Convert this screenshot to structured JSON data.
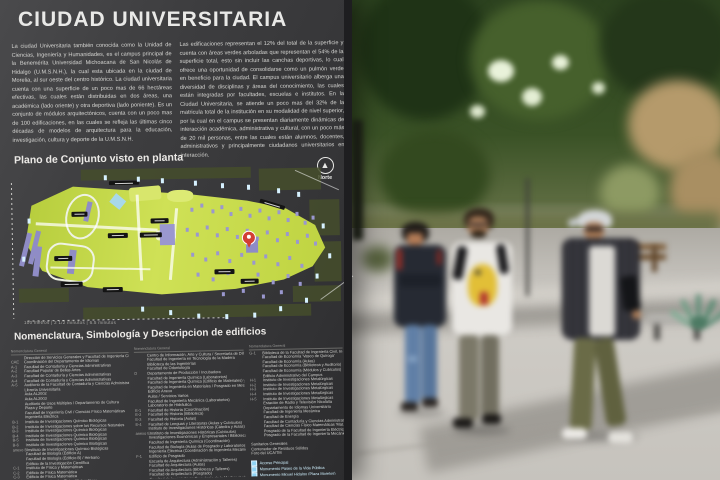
{
  "sign": {
    "title": "CIUDAD UNIVERSITARIA",
    "intro_left": "La ciudad Universitaria también conocida como la Unidad de Ciencias, Ingeniería y Humanidades, es el campus principal de la Benemérita Universidad Michoacana de San Nicolás de Hidalgo (U.M.S.N.H.), la cual esta ubicada en la ciudad de Morelia, al sur oeste del centro histórico. La ciudad universitaria cuenta con una superficie de un poco mas de 66 hectáreas efectivas, las cuales están distribuidas en dos áreas, una académica (lado oriente) y otra deportiva (lado poniente). Es un conjunto de módulos arquitectónicos, cuenta con un poco mas de 100 edificaciones, en las cuales se refleja las últimas cinco décadas de modelos de arquitectura para la educación, investigación, cultura y deporte de la U.M.S.N.H.",
    "intro_right": "Las edificaciones representan el 12% del total de la superficie y cuenta con áreas verdes arboladas que representan el 54% de la superficie total, esto sin incluir las canchas deportivas, lo cual ofrece una oportunidad de consolidarse como un pulmón verde en beneficio para la ciudad. El campus universitario alberga una diversidad de disciplinas y áreas del conocimiento, las cuales están integradas por facultades, escuelas e institutos. En la Ciudad Universitaria, se atiende un poco mas del 32% de la matricula total de la institución en su modalidad de nivel superior, por la cual en el campus se presentan diariamente dinámicas de interacción académica, administrativa y cultural, con un poco más de 20 mil personas, entre las cuales están alumnos, docentes, administrativos y principalmente ciudadanos universitarios en interacción.",
    "map": {
      "heading": "Plano de Conjunto visto en planta",
      "north_label": "Norte",
      "north_arrow_glyph": "▲",
      "scale_caption": "100 metros  |  2 1/2 minutos  |  6.5 minutos",
      "marker": "location-pin"
    },
    "legend": {
      "heading": "Nomenclatura, Simbología y Descripcion de edificios",
      "columns": [
        {
          "header": "Nomenclatura General",
          "entries": [
            {
              "code": "",
              "label": "Dirección de Servicios Generales y Facultad de Ingeniería Civil"
            },
            {
              "code": "CAE",
              "label": "Coordinación del Departamento de Idiomas"
            },
            {
              "code": "A-1",
              "label": "Facultad de Contaduría y Ciencias Administrativas"
            },
            {
              "code": "A-2",
              "label": "Facultad Popular de Bellas Artes"
            },
            {
              "code": "A-3",
              "label": "Facultad de Contaduría y Ciencias Administrativas"
            },
            {
              "code": "A-4",
              "label": "Facultad de Contaduría y Ciencias Administrativas"
            },
            {
              "code": "A-5",
              "label": "Auditorio de la Facultad de Contaduría y Ciencias Administrativas"
            },
            {
              "code": "",
              "label": "Librería Universitaria"
            },
            {
              "code": "",
              "label": "Aula AL2002"
            },
            {
              "code": "",
              "label": "Aula AL2003"
            },
            {
              "code": "",
              "label": "Auditorio de Usos Múltiples / Departamento de Cultura"
            },
            {
              "code": "",
              "label": "Plaza y Deporte"
            },
            {
              "code": "",
              "label": "Facultad de Ingeniería Civil / Ciencias Físico Matemáticas"
            },
            {
              "code": "",
              "label": "Ingeniería Eléctrica"
            },
            {
              "code": "B-1",
              "label": "Instituto de Investigaciones Químico Biológicas"
            },
            {
              "code": "B-2",
              "label": "Instituto de Investigaciones sobre los Recursos Naturales"
            },
            {
              "code": "B-3",
              "label": "Instituto de Investigaciones Químico Biológicas"
            },
            {
              "code": "B-4",
              "label": "Instituto de Investigaciones Químico Biológicas"
            },
            {
              "code": "B-5",
              "label": "Instituto de Investigaciones Químico Biológicas"
            },
            {
              "code": "B-6",
              "label": "Instituto de Investigaciones Químico Biológicas"
            },
            {
              "code": "anexo B",
              "label": "Instituto de Investigaciones Químico Biológicas"
            },
            {
              "code": "",
              "label": "Facultad de Biología (Edificio A)"
            },
            {
              "code": "",
              "label": "Facultad de Biología (Edificio B) / Herbario"
            },
            {
              "code": "",
              "label": "Edificio de la Investigación Científica"
            },
            {
              "code": "C-1",
              "label": "Instituto de Física y Matemáticas"
            },
            {
              "code": "C-2",
              "label": "Edificio de Física Matemática"
            },
            {
              "code": "C-3",
              "label": "Edificio de Física Matemática"
            },
            {
              "code": "",
              "label": "Facultad de Ciencias Físico Matemáticas"
            },
            {
              "code": "",
              "label": "Facultad de Filosofía"
            }
          ]
        },
        {
          "header": "Nomenclatura General",
          "entries": [
            {
              "code": "",
              "label": "Centro de Información, Arte y Cultura / Secretaría de Difusión Cultural"
            },
            {
              "code": "",
              "label": "Facultad de Ingeniería en Tecnología de la Madera"
            },
            {
              "code": "",
              "label": "Biblioteca de las Ingenierías"
            },
            {
              "code": "",
              "label": "Facultad de Odontología"
            },
            {
              "code": "D",
              "label": "Departamento de Producción / Incubadora"
            },
            {
              "code": "",
              "label": "Facultad de Ingeniería Química (Laboratorios)"
            },
            {
              "code": "",
              "label": "Facultad de Ingeniería Química (Edificio de Materiales) y Posgrado"
            },
            {
              "code": "",
              "label": "Facultad de Ingeniería en Materiales / Posgrado en Metalurgia"
            },
            {
              "code": "",
              "label": "Edificio Anexo"
            },
            {
              "code": "",
              "label": "Aulas / Servicios Varios"
            },
            {
              "code": "",
              "label": "Facultad de Ingeniería Mecánica (Laboratorios)"
            },
            {
              "code": "",
              "label": "Laboratorio de Hidráulica"
            },
            {
              "code": "E-1",
              "label": "Facultad de Historia (Coordinación)"
            },
            {
              "code": "E-2",
              "label": "Facultad de Historia (Biblioteca)"
            },
            {
              "code": "E-3",
              "label": "Facultad de Historia (Aulas)"
            },
            {
              "code": "E-4",
              "label": "Facultad de Lenguas y Literaturas (Aulas y Cubículos)"
            },
            {
              "code": "",
              "label": "Instituto de Investigaciones Históricas (Cátedra y Aulas)"
            },
            {
              "code": "anexo E",
              "label": "Instituto de Investigaciones Históricas (Cubículos)"
            },
            {
              "code": "",
              "label": "Investigaciones Económicas y Empresariales / Biblioteca y Hemeroteca"
            },
            {
              "code": "",
              "label": "Facultad de Ingeniería Química (Coordinación)"
            },
            {
              "code": "",
              "label": "Facultad de Biología (Aulas de Posgrado y Laboratorios)"
            },
            {
              "code": "",
              "label": "Ingeniería Eléctrica (Coordinación de Ingeniería Mecánica)"
            },
            {
              "code": "F-1",
              "label": "Edificio de Posgrado"
            },
            {
              "code": "",
              "label": "Escuela de Arquitectura (Administración y Talleres)"
            },
            {
              "code": "",
              "label": "Facultad de Arquitectura (Aulas)"
            },
            {
              "code": "",
              "label": "Facultad de Arquitectura (Biblioteca y Talleres)"
            },
            {
              "code": "",
              "label": "Facultad de Arquitectura (Posgrado)"
            },
            {
              "code": "",
              "label": "Facultad de Ingeniería en Tecnología de la Madera (Laboratorios)"
            },
            {
              "code": "",
              "label": "Facultad de Arquitectura (Talleres)"
            }
          ]
        },
        {
          "header": "Nomenclatura General",
          "entries": [
            {
              "code": "G-1",
              "label": "Biblioteca de la Facultad de Ingeniería Civil, Ingeniería Mecánica e Ingeniería en Tecnología de la Madera"
            },
            {
              "code": "",
              "label": "Facultad de Economía 'Vasco de Quiroga'"
            },
            {
              "code": "",
              "label": "Facultad de Economía (Aulas)"
            },
            {
              "code": "",
              "label": "Facultad de Economía (Biblioteca y Auditorio)"
            },
            {
              "code": "",
              "label": "Facultad de Economía (Módulos y Cubículos)"
            },
            {
              "code": "",
              "label": "Edificio Administrativo del Campus"
            },
            {
              "code": "H-1",
              "label": "Instituto de Investigaciones Metalúrgicas"
            },
            {
              "code": "H-2",
              "label": "Instituto de Investigaciones Metalúrgicas"
            },
            {
              "code": "H-3",
              "label": "Instituto de Investigaciones Metalúrgicas"
            },
            {
              "code": "H-4",
              "label": "Instituto de Investigaciones Metalúrgicas"
            },
            {
              "code": "H-5",
              "label": "Instituto de Investigaciones Metalúrgicas"
            },
            {
              "code": "",
              "label": "Estación de Radio y Televisión Nicolaita"
            },
            {
              "code": "",
              "label": "Departamento de Idiomas Universitario"
            },
            {
              "code": "",
              "label": "Facultad de Ingeniería Mecánica"
            },
            {
              "code": "",
              "label": "Facultad de Energía"
            },
            {
              "code": "",
              "label": "Facultad de Contaduría y Ciencias Administrativas"
            },
            {
              "code": "",
              "label": "Facultad de Ciencias Físico Matemáticas 'Mat. Luis Manuel Rivera Gutiérrez'"
            },
            {
              "code": "",
              "label": "Posgrado de la Facultad de Ingeniería Eléctrica"
            },
            {
              "code": "",
              "label": "Posgrado de la Facultad de Ingeniería Mecánica"
            }
          ]
        }
      ],
      "facilities": [
        "Sanitarios Generales",
        "Contenedor de Residuos Sólidos",
        "Foro del UCA/TM"
      ],
      "symbols": [
        "Acceso Principal",
        "Monumento Paseo de la Vida Pública",
        "Monumento Miguel Hidalgo (Plaza Morelos)",
        "Módulo del Arte y la Cultura"
      ]
    },
    "colors": {
      "sign_background": "#3a3a3c",
      "sign_text": "#e8e8e6",
      "map_campus_green": "#c8dc4e",
      "map_building_purple": "#9a97cf",
      "map_water_blue": "#a8d8ea",
      "map_marker_red": "#d23f33",
      "legend_accent_cyan": "#8fd4f5"
    }
  }
}
